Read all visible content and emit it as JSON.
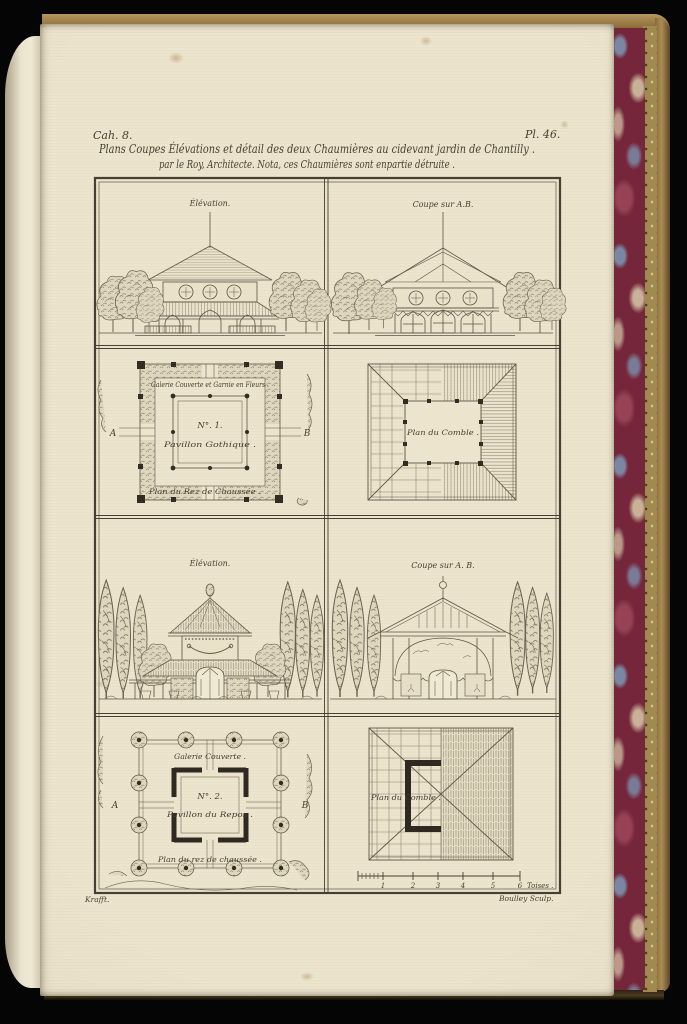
{
  "page": {
    "cahier": "Cah. 8.",
    "plate": "Pl. 46.",
    "title_line1": "Plans Coupes Élévations et détail des deux Chaumières au cidevant jardin de Chantilly .",
    "title_line2": "par le Roy, Architecte. Nota, ces Chaumières sont enpartie détruite .",
    "credit_left": "Krafft.",
    "credit_right": "Boulley Sculp."
  },
  "panels": {
    "p1": {
      "label": "Élévation."
    },
    "p2": {
      "label": "Coupe sur A.B."
    },
    "p3": {
      "gallery": "Galerie Couverte et Garnie en Fleurs .",
      "number": "N°. 1.",
      "name": "Pavillon Gothique .",
      "plan": "Plan du Rez de Chaussée .",
      "marker_a": "A",
      "marker_b": "B"
    },
    "p4": {
      "label": "Plan du Comble ."
    },
    "p5": {
      "label": "Élévation."
    },
    "p6": {
      "label": "Coupe sur A. B."
    },
    "p7": {
      "gallery": "Galerie Couverte .",
      "number": "N°. 2.",
      "name": "Pavillon du Repos .",
      "plan": "Plan du rez de chaussée .",
      "marker_a": "A",
      "marker_b": "B"
    },
    "p8": {
      "label": "Plan du Comble .",
      "scale_ticks": [
        "1",
        "2",
        "3",
        "4",
        "5",
        "6"
      ],
      "scale_unit": "Toises ."
    }
  },
  "colors": {
    "paper": "#ece4cd",
    "ink": "#474032",
    "drawing": "#6b6351",
    "marble_red": "#75263a",
    "marble_blue": "#7b90ad",
    "edge_gold": "#a18a50",
    "cover_tan": "#91713d"
  }
}
